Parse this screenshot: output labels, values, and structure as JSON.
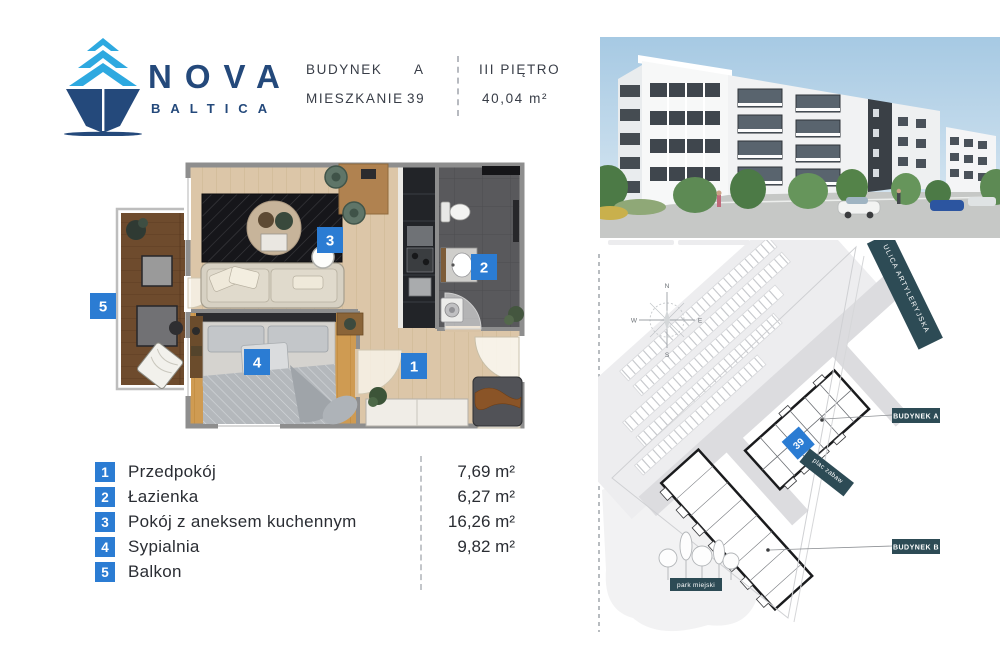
{
  "brand": {
    "name_top": "NOVA",
    "name_bottom": "BALTICA"
  },
  "header": {
    "building_label": "BUDYNEK",
    "building_value": "A",
    "apartment_label": "MIESZKANIE",
    "apartment_value": "39",
    "floor_label": "III PIĘTRO",
    "area_label": "40,04 m²"
  },
  "floor_plan": {
    "room_markers": [
      "1",
      "2",
      "3",
      "4",
      "5"
    ]
  },
  "legend": {
    "items": [
      {
        "num": "1",
        "name": "Przedpokój",
        "area": "7,69 m²"
      },
      {
        "num": "2",
        "name": "Łazienka",
        "area": "6,27 m²"
      },
      {
        "num": "3",
        "name": "Pokój z aneksem kuchennym",
        "area": "16,26 m²"
      },
      {
        "num": "4",
        "name": "Sypialnia",
        "area": "9,82 m²"
      },
      {
        "num": "5",
        "name": "Balkon",
        "area": ""
      }
    ]
  },
  "site_plan": {
    "street_banner": "ULICA ARTYLERYJSKA",
    "building_a_label": "BUDYNEK A",
    "building_b_label": "BUDYNEK B",
    "playground_label": "plac zabaw",
    "park_label": "park miejski",
    "unit_marker": "39",
    "compass": {
      "n": "N",
      "e": "E",
      "s": "S",
      "w": "W"
    }
  },
  "colors": {
    "navy": "#24497b",
    "light_blue": "#2ea9e0",
    "badge_blue": "#2b7cd3",
    "teal": "#2d4b55"
  }
}
